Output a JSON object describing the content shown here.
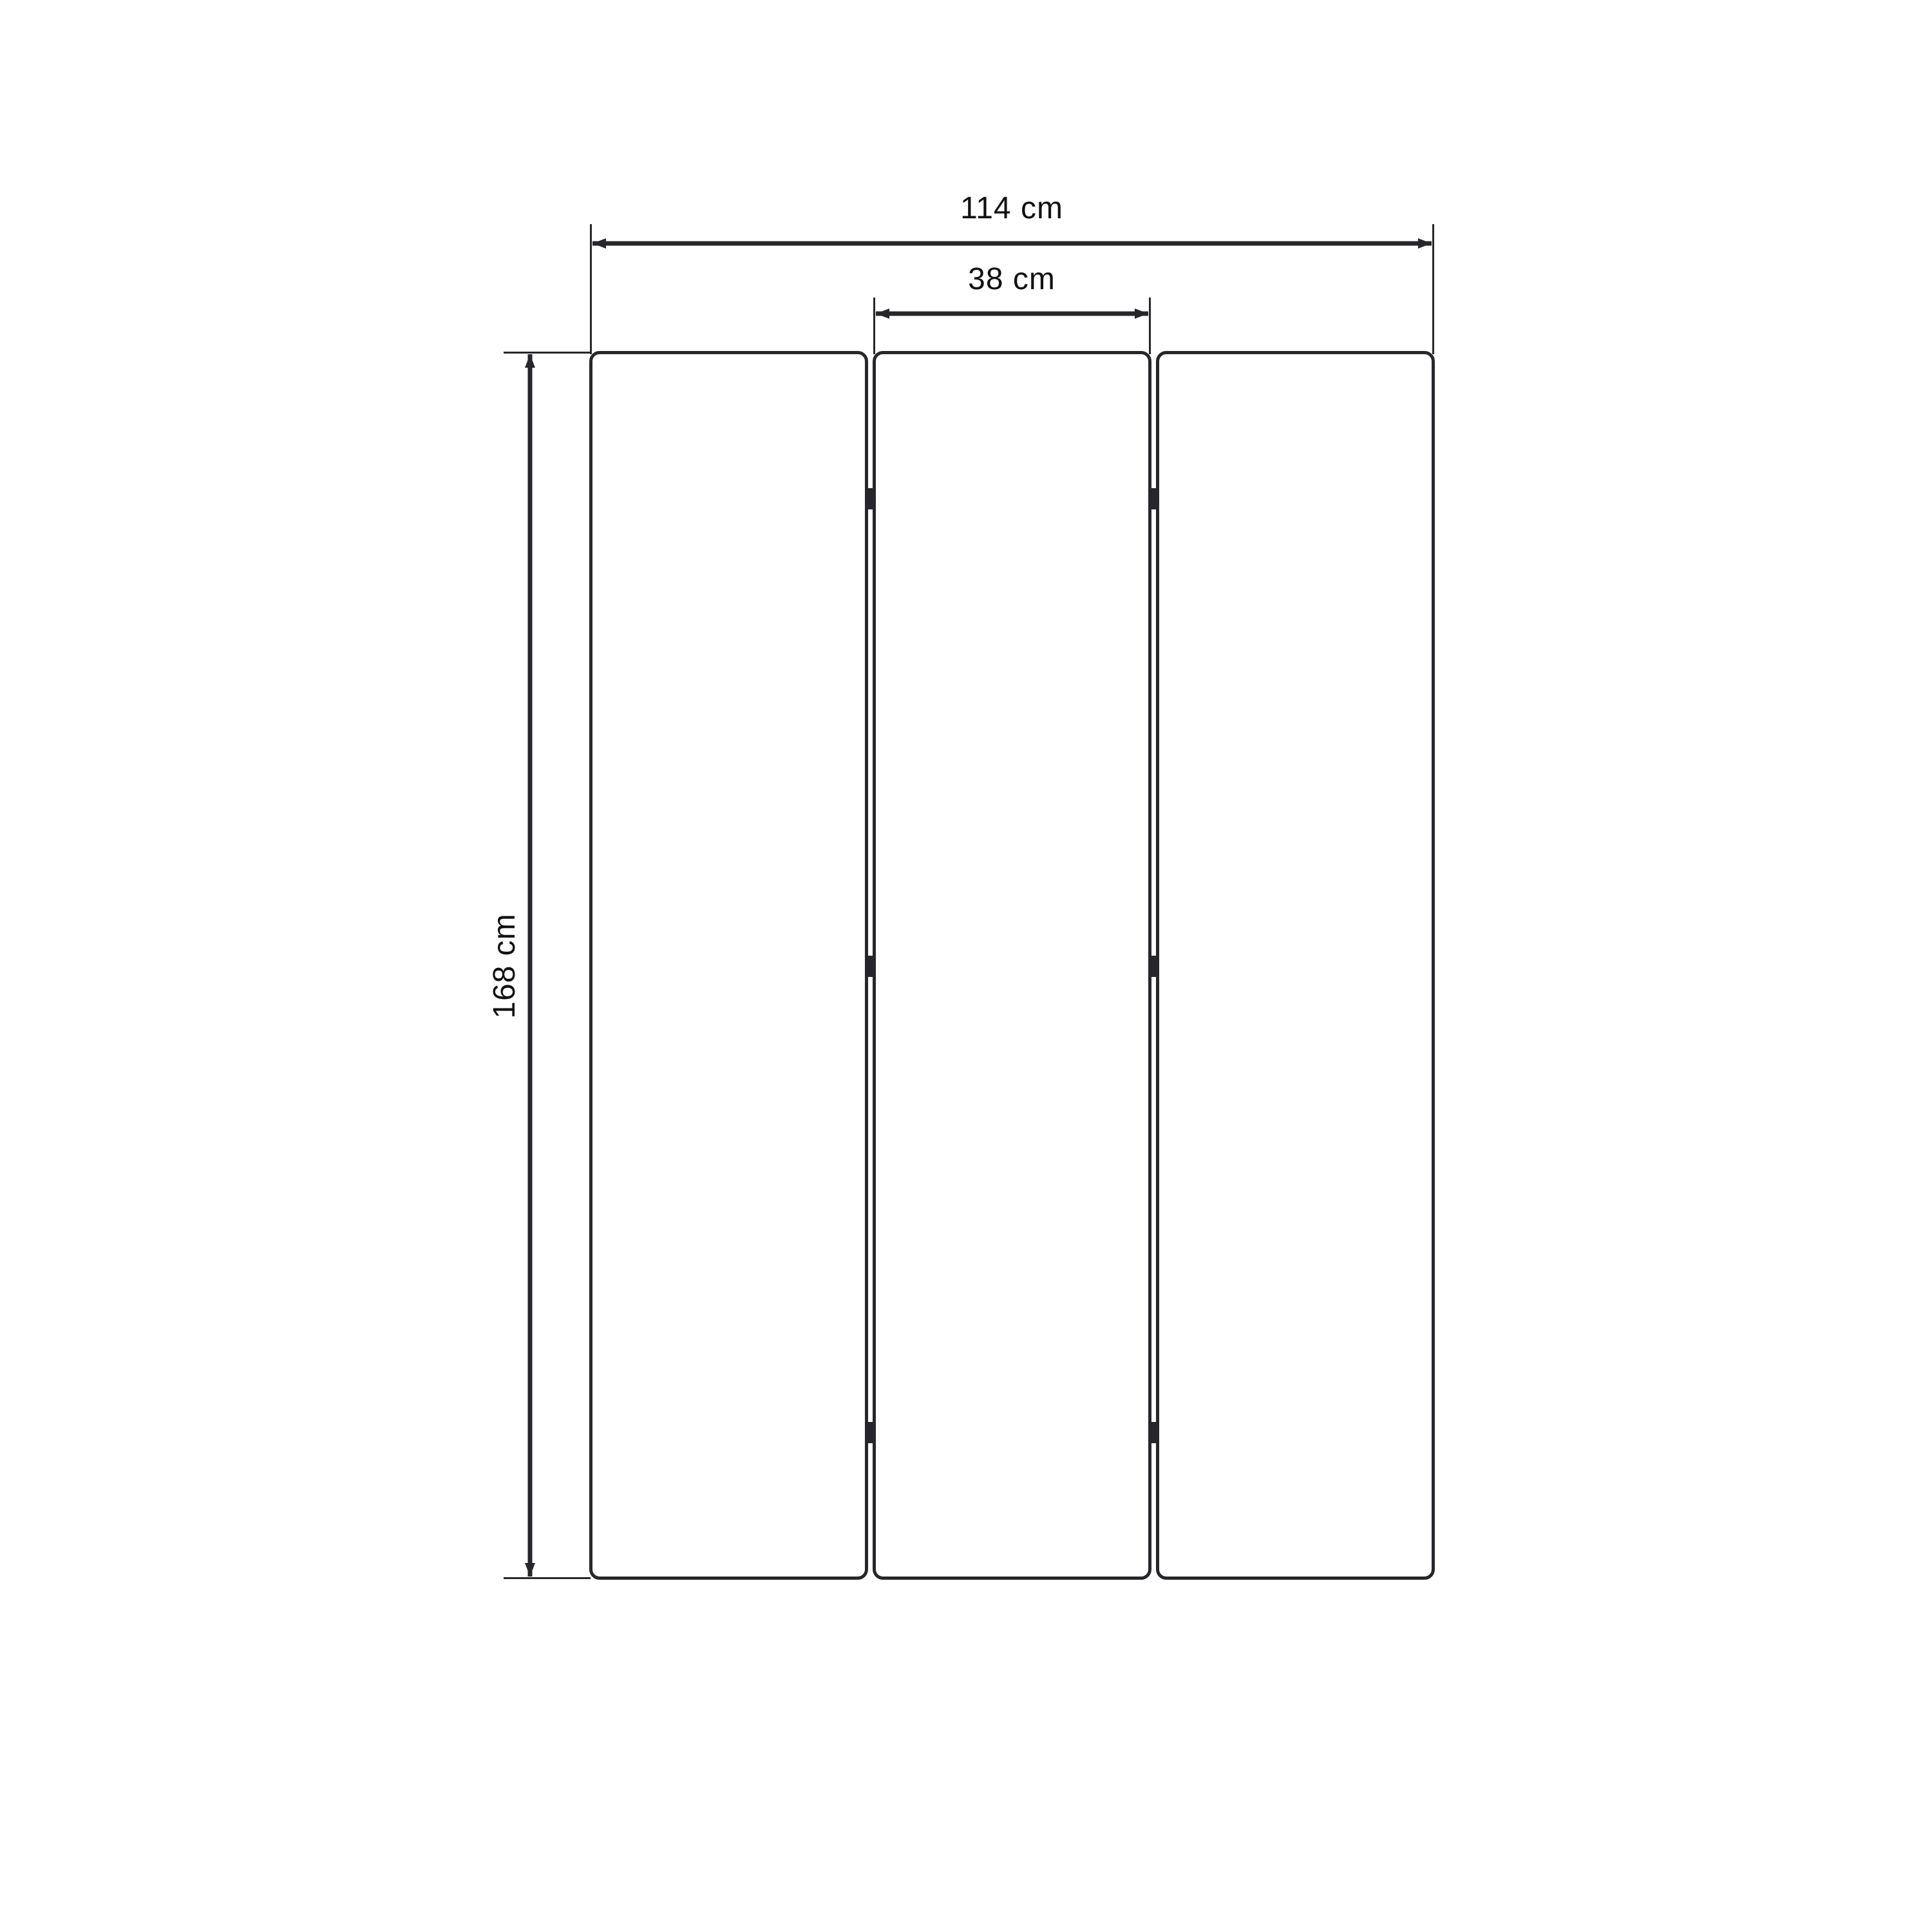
{
  "diagram": {
    "title": "three-panel dimension drawing",
    "panel_count": 3,
    "dimensions": {
      "overall_width_label": "114 cm",
      "panel_width_label": "38 cm",
      "height_label": "168 cm"
    },
    "colors": {
      "line": "#27272b",
      "text": "#111113",
      "background": "#ffffff"
    }
  }
}
